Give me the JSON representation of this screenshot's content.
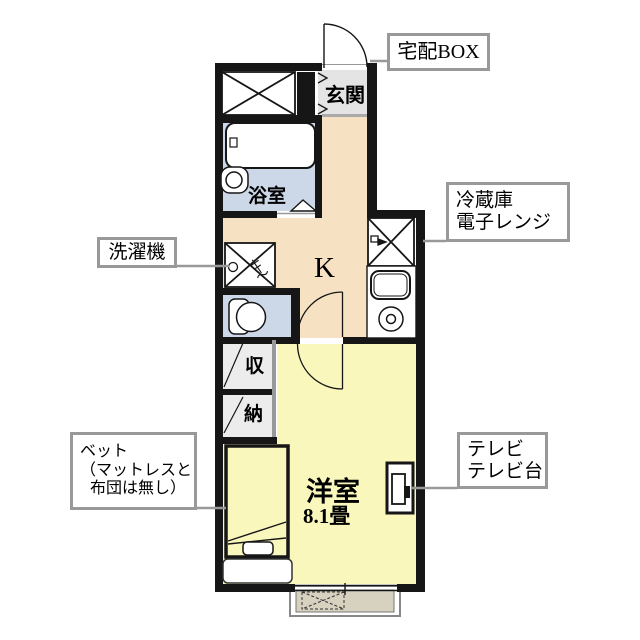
{
  "floorplan": {
    "callouts": {
      "delivery_box": "宅配BOX",
      "fridge_line1": "冷蔵庫",
      "fridge_line2": "電子レンジ",
      "washer": "洗濯機",
      "bed_line1": "ベット",
      "bed_line2": "（マットレスと",
      "bed_line3": "布団は無し）",
      "tv_line1": "テレビ",
      "tv_line2": "テレビ台"
    },
    "rooms": {
      "entrance": "玄関",
      "bathroom": "浴室",
      "kitchen": "K",
      "closet_top": "収",
      "closet_bottom": "納",
      "western_room": "洋室",
      "western_room_size": "8.1畳"
    },
    "colors": {
      "wall": "#161616",
      "kitchen_floor": "#f6e2c3",
      "room_floor": "#faf7bd",
      "wet_area_floor": "#ccd7e8",
      "entrance_floor": "#e4e4e4",
      "closet_floor": "#ececec",
      "balcony_floor": "#d7d2c0",
      "callout_border": "#999999",
      "leader_line": "#999999"
    }
  }
}
